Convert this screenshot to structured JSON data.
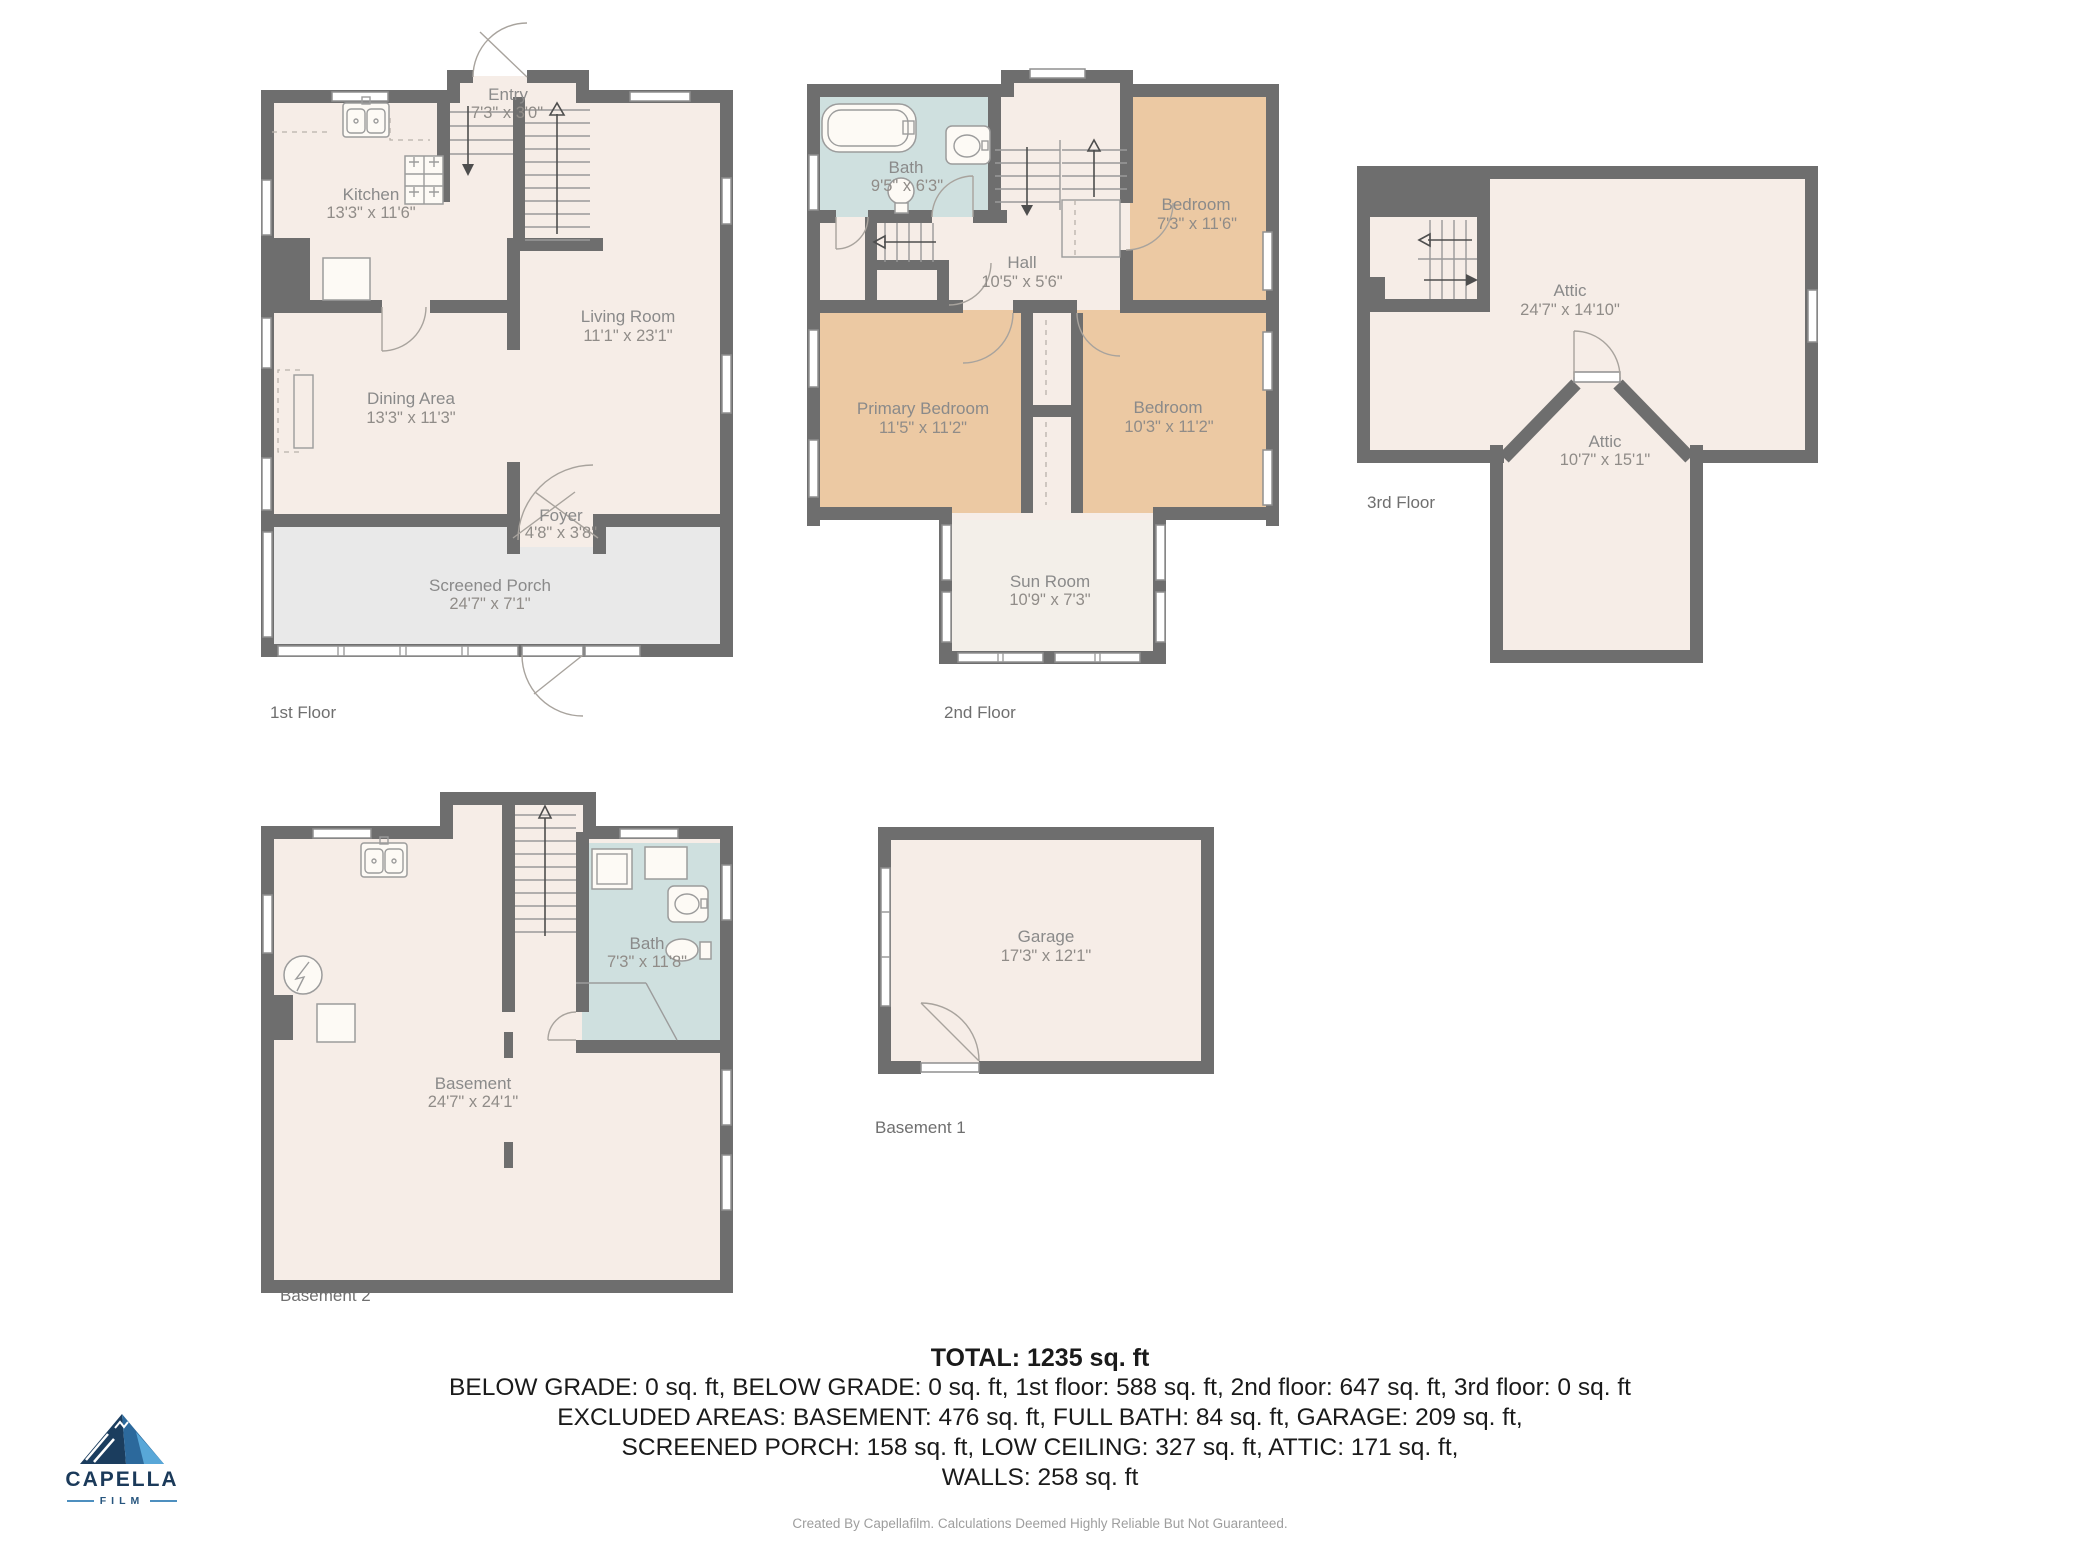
{
  "floors": {
    "first": {
      "label": "1st Floor",
      "rooms": {
        "entry": {
          "name": "Entry",
          "dims": "7'3\" x 3'0\""
        },
        "kitchen": {
          "name": "Kitchen",
          "dims": "13'3\" x 11'6\""
        },
        "living": {
          "name": "Living Room",
          "dims": "11'1\" x 23'1\""
        },
        "dining": {
          "name": "Dining Area",
          "dims": "13'3\" x 11'3\""
        },
        "foyer": {
          "name": "Foyer",
          "dims": "4'8\" x 3'8\""
        },
        "porch": {
          "name": "Screened Porch",
          "dims": "24'7\" x 7'1\""
        }
      }
    },
    "second": {
      "label": "2nd Floor",
      "rooms": {
        "bath": {
          "name": "Bath",
          "dims": "9'5\" x 6'3\""
        },
        "hall": {
          "name": "Hall",
          "dims": "10'5\" x 5'6\""
        },
        "bedroom1": {
          "name": "Bedroom",
          "dims": "7'3\" x 11'6\""
        },
        "primary": {
          "name": "Primary Bedroom",
          "dims": "11'5\" x 11'2\""
        },
        "bedroom2": {
          "name": "Bedroom",
          "dims": "10'3\" x 11'2\""
        },
        "sunroom": {
          "name": "Sun Room",
          "dims": "10'9\" x 7'3\""
        }
      }
    },
    "third": {
      "label": "3rd Floor",
      "rooms": {
        "attic1": {
          "name": "Attic",
          "dims": "24'7\" x 14'10\""
        },
        "attic2": {
          "name": "Attic",
          "dims": "10'7\" x 15'1\""
        }
      }
    },
    "basement2": {
      "label": "Basement 2",
      "rooms": {
        "basement": {
          "name": "Basement",
          "dims": "24'7\" x 24'1\""
        },
        "bath": {
          "name": "Bath",
          "dims": "7'3\" x 11'8\""
        }
      }
    },
    "basement1": {
      "label": "Basement 1",
      "rooms": {
        "garage": {
          "name": "Garage",
          "dims": "17'3\" x 12'1\""
        }
      }
    }
  },
  "summary": {
    "total": "TOTAL: 1235 sq. ft",
    "lines": [
      "BELOW GRADE: 0 sq. ft, BELOW GRADE: 0 sq. ft, 1st floor: 588 sq. ft, 2nd floor: 647 sq. ft, 3rd floor: 0 sq. ft",
      "EXCLUDED AREAS: BASEMENT: 476 sq. ft, FULL BATH: 84 sq. ft, GARAGE: 209 sq. ft,",
      "SCREENED PORCH: 158 sq. ft, LOW CEILING: 327 sq. ft, ATTIC: 171 sq. ft,",
      "WALLS: 258 sq. ft"
    ],
    "disclaimer": "Created By Capellafilm. Calculations Deemed Highly Reliable But Not Guaranteed."
  },
  "logo": {
    "brand": "CAPELLA",
    "subtitle": "FILM",
    "icon": "mountain-icon"
  },
  "icons": {
    "logo": "mountain-icon",
    "fixtures": [
      "bathtub-icon",
      "sink-icon",
      "toilet-icon",
      "stove-icon",
      "refrigerator-icon",
      "washer-icon",
      "dryer-icon",
      "water-heater-icon",
      "electrical-panel-icon",
      "shower-icon",
      "stairs-icon",
      "door-arc-icon",
      "window-icon"
    ]
  },
  "colors": {
    "wall": "#6e6e6e",
    "room": "#f6ede7",
    "bedroom": "#ecc9a3",
    "bath": "#cfe0df",
    "porch": "#e9e9e9",
    "sunroom": "#f3efe9",
    "label": "#8a8a8a",
    "summary_text": "#1a1a1a",
    "logo_navy": "#1b3a5a",
    "logo_blue": "#4d8fbf"
  }
}
